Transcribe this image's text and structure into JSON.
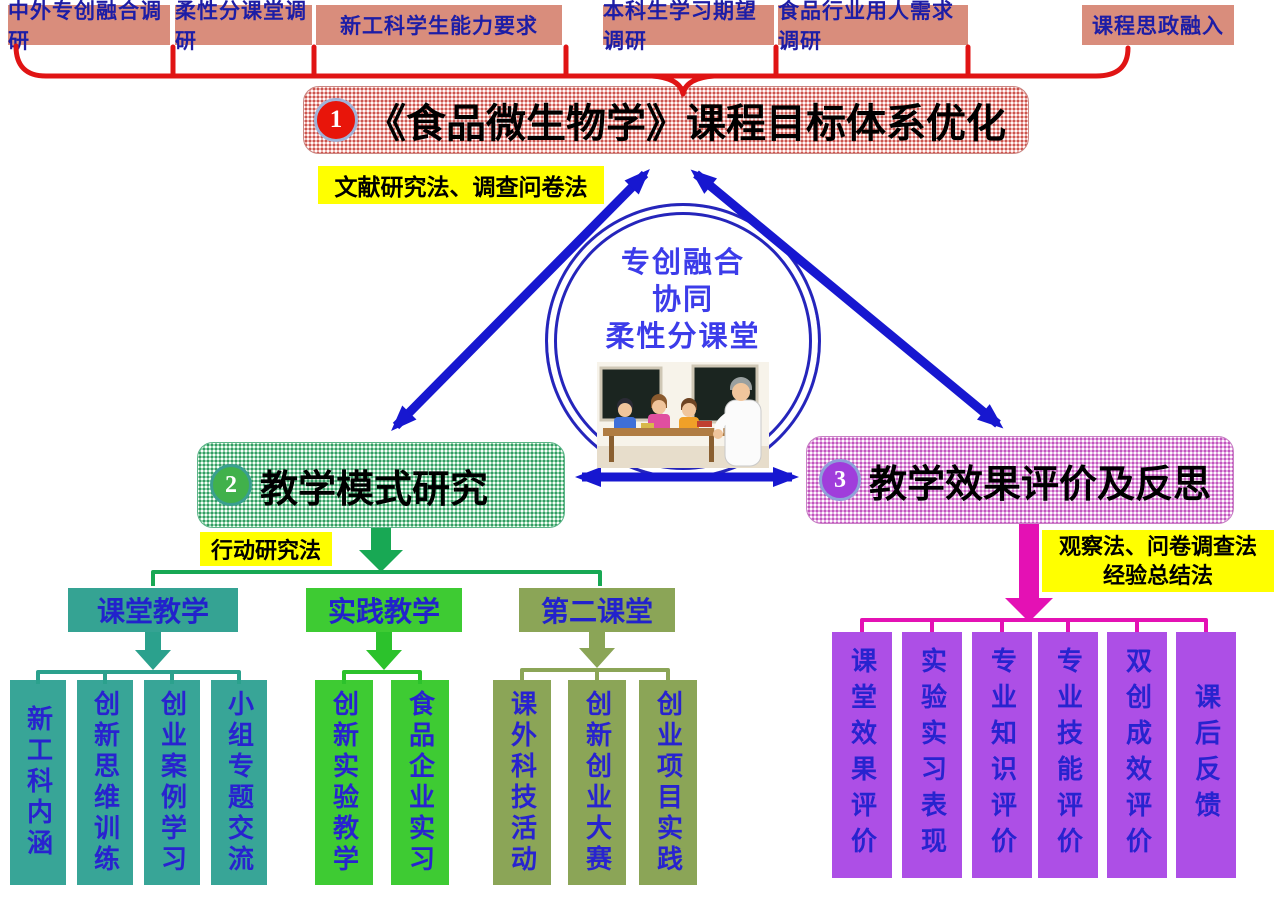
{
  "top_row": {
    "items": [
      {
        "label": "中外专创融合调研"
      },
      {
        "label": "柔性分课堂调研"
      },
      {
        "label": "新工科学生能力要求"
      },
      {
        "label": "本科生学习期望调研"
      },
      {
        "label": "食品行业用人需求调研"
      },
      {
        "label": "课程思政融入"
      }
    ]
  },
  "stage1": {
    "badge": "1",
    "title": "《食品微生物学》课程目标体系优化",
    "method_label": "文献研究法、调查问卷法"
  },
  "center": {
    "lines": [
      "专创融合",
      "协同",
      "柔性分课堂"
    ],
    "illustration": "classroom-teacher-students-cartoon"
  },
  "stage2": {
    "badge": "2",
    "title": "教学模式研究",
    "method_label": "行动研究法",
    "branches": [
      {
        "label": "课堂教学",
        "children": [
          "新工科内涵",
          "创新思维训练",
          "创业案例学习",
          "小组专题交流"
        ]
      },
      {
        "label": "实践教学",
        "children": [
          "创新实验教学",
          "食品企业实习"
        ]
      },
      {
        "label": "第二课堂",
        "children": [
          "课外科技活动",
          "创新创业大赛",
          "创业项目实践"
        ]
      }
    ]
  },
  "stage3": {
    "badge": "3",
    "title": "教学效果评价及反思",
    "method_label_line1": "观察法、问卷调查法",
    "method_label_line2": "经验总结法",
    "items": [
      "课堂效果评价",
      "实验实习表现",
      "专业知识评价",
      "专业技能评价",
      "双创成效评价",
      "课后反馈"
    ]
  },
  "colors": {
    "salmon_box": "#d98d7c",
    "navy_text": "#1d1da6",
    "red_connector": "#e01414",
    "title_pattern_pink": "#eeafab",
    "yellow_label": "#ffff00",
    "blue_arrow": "#1717d0",
    "stage2_pattern_green": "#8ed2a8",
    "stage3_pattern_pink": "#e3a6e0",
    "teal_box": "#38a597",
    "bright_green_box": "#3ecb33",
    "olive_box": "#8ba557",
    "purple_box": "#ad4fe6",
    "magenta_connector": "#e411b4",
    "green_connector": "#18a854",
    "leaf_text_blue": "#2823cf"
  }
}
